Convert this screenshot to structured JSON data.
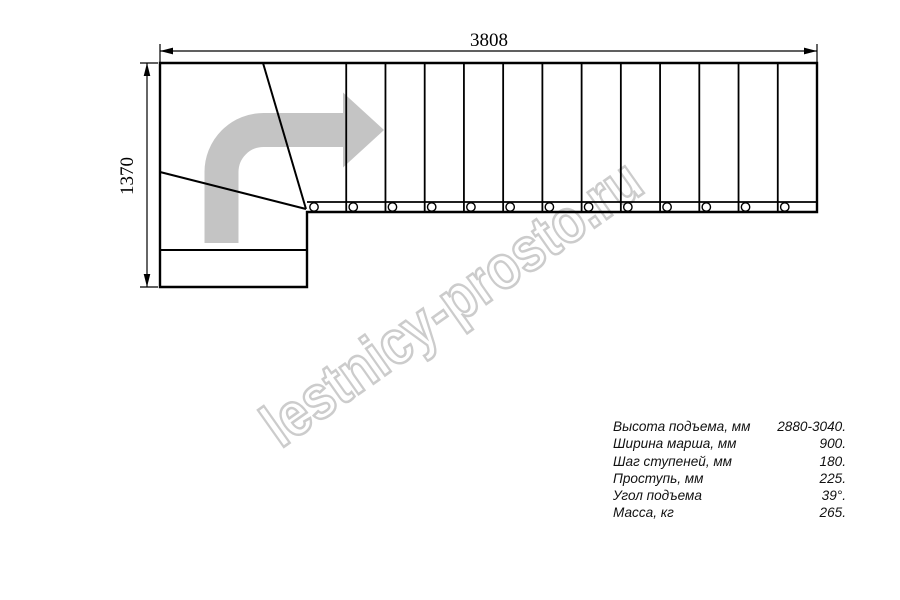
{
  "drawing": {
    "dim_width_label": "3808",
    "dim_height_label": "1370",
    "stair": {
      "treads": 13,
      "left": 307,
      "right": 817,
      "top": 63,
      "bottom": 212,
      "strip_top": 202,
      "circle_dx": 7,
      "circle_cy": 207,
      "circle_r": 4.2
    }
  },
  "icons": {
    "direction_arrow": "curved-right-turn-arrow"
  },
  "watermark": {
    "text": "lestnicy-prosto.ru"
  },
  "specs": {
    "rows": [
      {
        "label": "Высота подъема, мм",
        "value": "2880-3040."
      },
      {
        "label": "Ширина марша, мм",
        "value": "900."
      },
      {
        "label": "Шаг ступеней, мм",
        "value": "180."
      },
      {
        "label": "Проступь, мм",
        "value": "225."
      },
      {
        "label": "Угол подъема",
        "value": "39°."
      },
      {
        "label": "Масса, кг",
        "value": "265."
      }
    ]
  },
  "colors": {
    "line": "#000000",
    "arrow_fill": "#c4c4c4",
    "watermark": "#cccccc",
    "background": "#ffffff"
  }
}
